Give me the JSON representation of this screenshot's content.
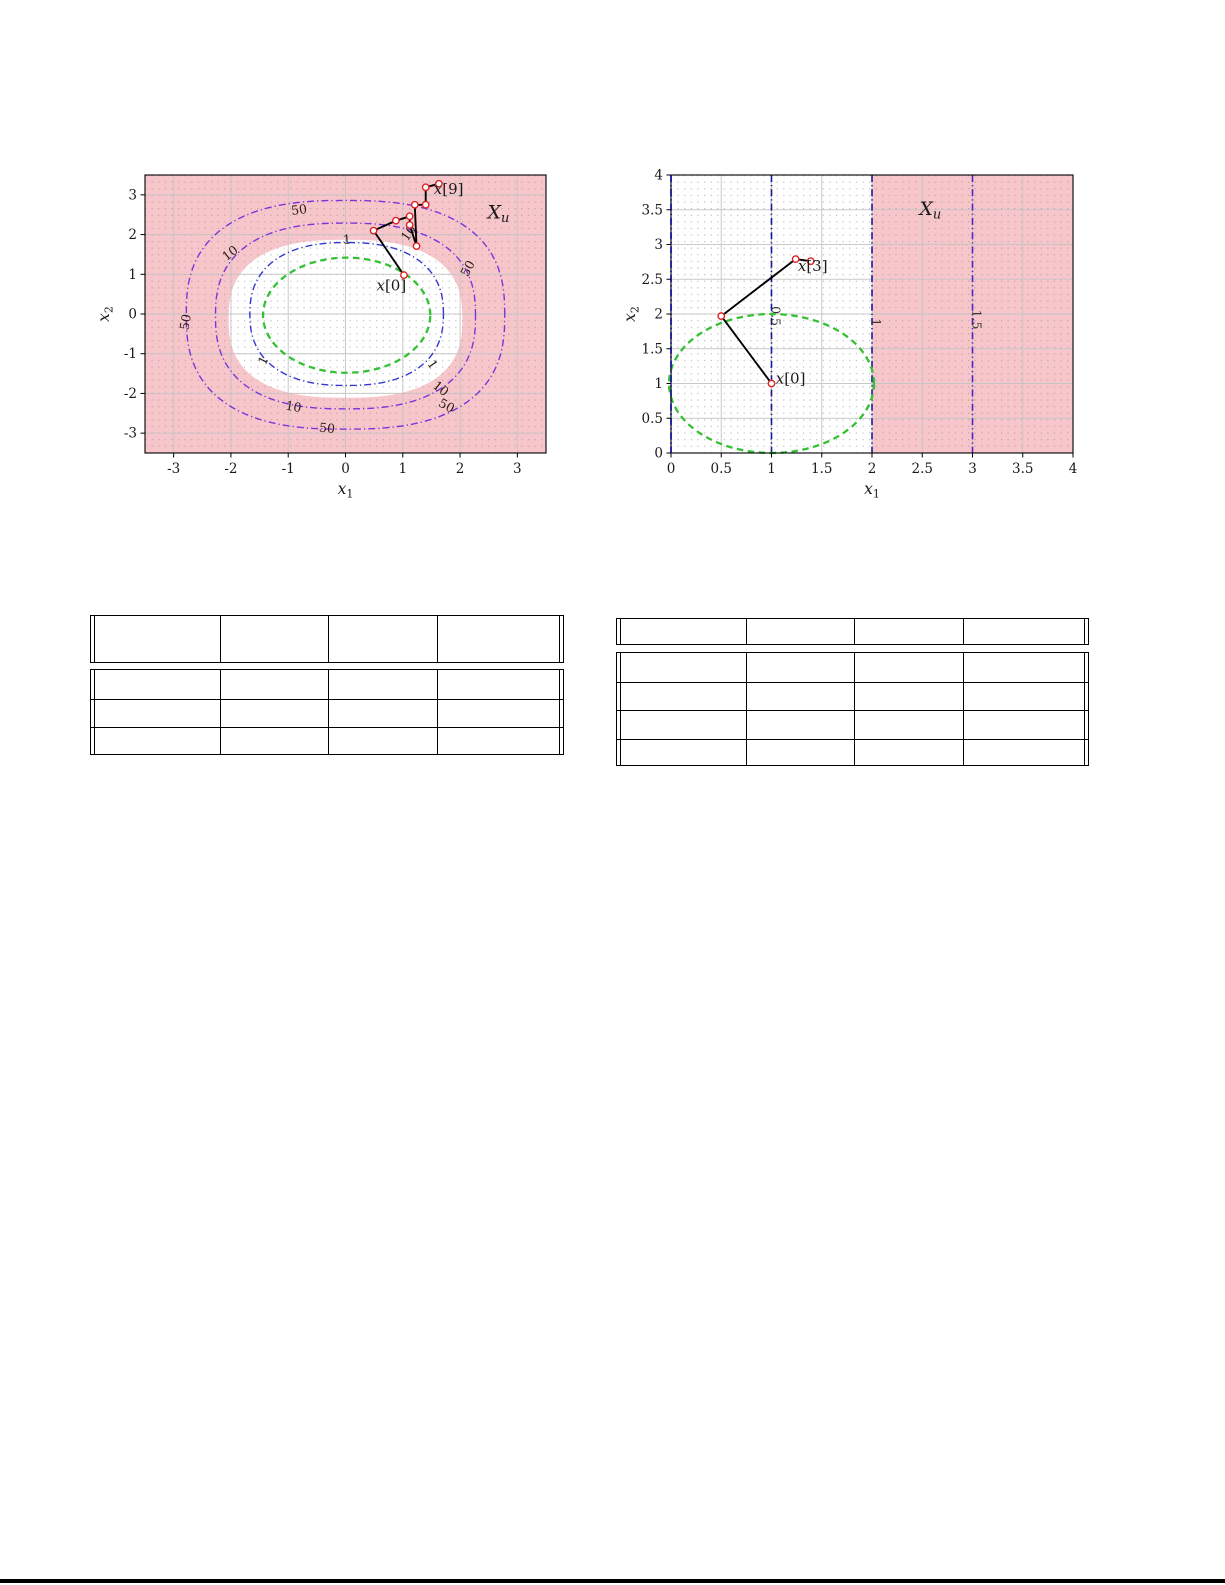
{
  "page": {
    "background": "#ffffff",
    "bottom_rule": {
      "color": "#000000",
      "y": 1579,
      "height": 4
    }
  },
  "chart_data": [
    {
      "id": "left",
      "type": "line",
      "subtype": "contour-map-with-trajectory",
      "title": "",
      "xlabel": {
        "main": "x",
        "sub": "1"
      },
      "ylabel": {
        "main": "x",
        "sub": "2"
      },
      "xlim": [
        -3.5,
        3.5
      ],
      "ylim": [
        -3.5,
        3.5
      ],
      "xtick_vals": [
        -3,
        -2,
        -1,
        0,
        1,
        2,
        3
      ],
      "xtick_labels": [
        "-3",
        "-2",
        "-1",
        "0",
        "1",
        "2",
        "3"
      ],
      "ytick_vals": [
        3,
        2,
        1,
        0,
        -1,
        -2,
        -3
      ],
      "ytick_labels": [
        "3",
        "2",
        "1",
        "0",
        "-1",
        "-2",
        "-3"
      ],
      "grid": {
        "dot_color": "#8a8a8a",
        "major_color": "#c4c4c4",
        "legend": "off"
      },
      "colors": {
        "unsafe_fill": "#f7c6cb",
        "safe_fill": "#ffffff",
        "contour_purple": "#7d35d9",
        "contour_blue": "#3338cf",
        "invariant_green": "#33c133",
        "trajectory": "#000000",
        "marker": "#dd2222",
        "contour_label": "#2a1c12",
        "tick_label": "#1a1a1a"
      },
      "unsafe_set_label": {
        "main": "X",
        "sub": "u",
        "x": 2.67,
        "y": 2.56
      },
      "safe_blob": {
        "cx": 0,
        "cy": -0.12,
        "rx": 2.04,
        "ry": 1.99,
        "sq": 0.78
      },
      "contours": [
        {
          "level": "50",
          "color_key": "contour_purple",
          "cx": 0,
          "cy": -0.02,
          "rx": 2.78,
          "ry": 2.88,
          "sq": 0.78,
          "labels": [
            {
              "x": -0.8,
              "y": 2.62,
              "rot": -8
            },
            {
              "x": -2.72,
              "y": -0.12,
              "rot": -80
            },
            {
              "x": 2.2,
              "y": 1.2,
              "rot": -62
            },
            {
              "x": 1.73,
              "y": -2.3,
              "rot": 28
            },
            {
              "x": -0.33,
              "y": -2.88,
              "rot": 6
            }
          ]
        },
        {
          "level": "10",
          "color_key": "contour_purple",
          "cx": 0,
          "cy": -0.05,
          "rx": 2.27,
          "ry": 2.34,
          "sq": 0.8,
          "labels": [
            {
              "x": -1.97,
              "y": 1.55,
              "rot": -38
            },
            {
              "x": 1.16,
              "y": 2.08,
              "rot": -55
            },
            {
              "x": -0.92,
              "y": -2.34,
              "rot": 10
            },
            {
              "x": 1.62,
              "y": -1.86,
              "rot": 38
            }
          ]
        },
        {
          "level": "1",
          "color_key": "contour_blue",
          "cx": 0.02,
          "cy": 0,
          "rx": 1.69,
          "ry": 1.8,
          "sq": 0.84,
          "labels": [
            {
              "x": 0.03,
              "y": 1.87,
              "rot": -4
            },
            {
              "x": -1.37,
              "y": -1.12,
              "rot": -62
            },
            {
              "x": 1.46,
              "y": -1.23,
              "rot": 55
            }
          ]
        }
      ],
      "invariant_set": {
        "cx": 0.02,
        "cy": -0.03,
        "rx": 1.46,
        "ry": 1.45,
        "sq": 1.0
      },
      "trajectory": [
        [
          1.02,
          0.98
        ],
        [
          0.49,
          2.1
        ],
        [
          0.88,
          2.35
        ],
        [
          1.12,
          2.46
        ],
        [
          1.12,
          2.24
        ],
        [
          1.24,
          1.71
        ],
        [
          1.21,
          2.75
        ],
        [
          1.4,
          2.75
        ],
        [
          1.4,
          3.19
        ],
        [
          1.63,
          3.28
        ]
      ],
      "point_labels": [
        {
          "var": "x",
          "idx": "[0]",
          "x": 0.8,
          "y": 0.72
        },
        {
          "var": "x",
          "idx": "[9]",
          "x": 1.8,
          "y": 3.15
        }
      ]
    },
    {
      "id": "right",
      "type": "line",
      "subtype": "contour-map-with-trajectory",
      "title": "",
      "xlabel": {
        "main": "x",
        "sub": "1"
      },
      "ylabel": {
        "main": "x",
        "sub": "2"
      },
      "xlim": [
        0,
        4
      ],
      "ylim": [
        0,
        4
      ],
      "xtick_vals": [
        0,
        0.5,
        1,
        1.5,
        2,
        2.5,
        3,
        3.5,
        4
      ],
      "xtick_labels": [
        "0",
        "0.5",
        "1",
        "1.5",
        "2",
        "2.5",
        "3",
        "3.5",
        "4"
      ],
      "ytick_vals": [
        0,
        0.5,
        1,
        1.5,
        2,
        2.5,
        3,
        3.5,
        4
      ],
      "ytick_labels": [
        "0",
        "0.5",
        "1",
        "1.5",
        "2",
        "2.5",
        "3",
        "3.5",
        "4"
      ],
      "grid": {
        "dot_color": "#8a8a8a",
        "major_color": "#c4c4c4",
        "legend": "off"
      },
      "colors": {
        "unsafe_fill": "#f7c6cb",
        "vline_navy": "#18189b",
        "vline_violet": "#5c22c0",
        "invariant_green": "#33c133",
        "trajectory": "#000000",
        "marker": "#dd2222",
        "contour_label": "#333333",
        "tick_label": "#1a1a1a"
      },
      "unsafe_region_x_start": 2,
      "vlines": [
        {
          "x": 0,
          "level": "",
          "color_key": "vline_navy"
        },
        {
          "x": 1,
          "level": "0.5",
          "color_key": "vline_navy",
          "label_y": 1.97
        },
        {
          "x": 2,
          "level": "1",
          "color_key": "vline_navy",
          "label_y": 1.88
        },
        {
          "x": 3,
          "level": "1.5",
          "color_key": "vline_violet",
          "label_y": 1.92
        }
      ],
      "invariant_set": {
        "cx": 1,
        "cy": 1,
        "rx": 1.02,
        "ry": 1.0,
        "sq": 1.0
      },
      "trajectory": [
        [
          1.0,
          1.0
        ],
        [
          0.5,
          1.97
        ],
        [
          1.24,
          2.79
        ],
        [
          1.39,
          2.76
        ]
      ],
      "point_labels": [
        {
          "var": "x",
          "idx": "[0]",
          "x": 1.19,
          "y": 1.07
        },
        {
          "var": "x",
          "idx": "[3]",
          "x": 1.41,
          "y": 2.69
        }
      ],
      "unsafe_set_label": {
        "main": "X",
        "sub": "u",
        "x": 2.58,
        "y": 3.51
      }
    }
  ],
  "tables": [
    {
      "id": "left-table",
      "columns": 4,
      "header": [
        "",
        "",
        "",
        ""
      ],
      "rows": [
        [
          "",
          "",
          "",
          ""
        ],
        [
          "",
          "",
          "",
          ""
        ],
        [
          "",
          "",
          "",
          ""
        ]
      ]
    },
    {
      "id": "right-table",
      "columns": 4,
      "header": [
        "",
        "",
        "",
        ""
      ],
      "rows": [
        [
          "",
          "",
          "",
          ""
        ],
        [
          "",
          "",
          "",
          ""
        ],
        [
          "",
          "",
          "",
          ""
        ],
        [
          "",
          "",
          "",
          ""
        ]
      ]
    }
  ]
}
